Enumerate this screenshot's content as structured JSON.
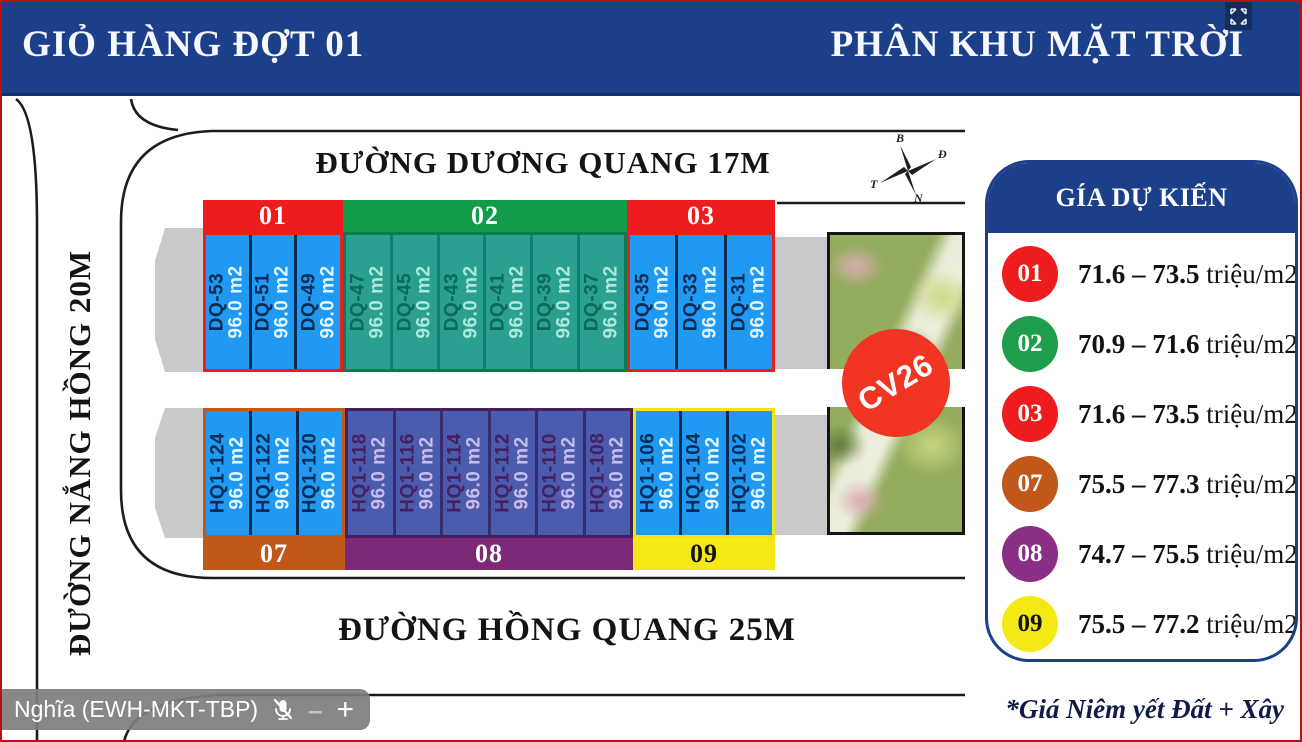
{
  "header": {
    "left_title": "GIỎ HÀNG ĐỢT 01",
    "right_title": "PHÂN KHU MẶT TRỜI",
    "bar_color": "#1c3f8a"
  },
  "streets": {
    "top": "ĐƯỜNG DƯƠNG QUANG 17M",
    "left": "ĐƯỜNG NẮNG HỒNG 20M",
    "bottom": "ĐƯỜNG HỒNG QUANG 25M"
  },
  "compass": {
    "north": "B",
    "east": "Đ",
    "west": "T",
    "south": "N"
  },
  "park": {
    "label": "CV26",
    "circle_color": "#f03522"
  },
  "map": {
    "blocks": [
      {
        "id": "01",
        "row": "top",
        "label": "01",
        "chrome": "#ee1c1c",
        "label_text": "#ffffff",
        "cell_bg": "#1f99f2",
        "name_color": "#0b2b55",
        "area_color": "#e2f7ff",
        "divider": "#0b2b55",
        "plots": [
          {
            "name": "DQ-53",
            "area": "96.0 m2"
          },
          {
            "name": "DQ-51",
            "area": "96.0 m2"
          },
          {
            "name": "DQ-49",
            "area": "96.0 m2"
          }
        ]
      },
      {
        "id": "02",
        "row": "top",
        "label": "02",
        "chrome": "#129b49",
        "label_text": "#ffffff",
        "cell_bg": "#2b9f90",
        "name_color": "#0a6a58",
        "area_color": "#aaeadb",
        "divider": "#0d8070",
        "border": "#0c7a4f",
        "plots": [
          {
            "name": "DQ-47",
            "area": "96.0 m2"
          },
          {
            "name": "DQ-45",
            "area": "96.0 m2"
          },
          {
            "name": "DQ-43",
            "area": "96.0 m2"
          },
          {
            "name": "DQ-41",
            "area": "96.0 m2"
          },
          {
            "name": "DQ-39",
            "area": "96.0 m2"
          },
          {
            "name": "DQ-37",
            "area": "96.0 m2"
          }
        ]
      },
      {
        "id": "03",
        "row": "top",
        "label": "03",
        "chrome": "#ee1c1c",
        "label_text": "#ffffff",
        "cell_bg": "#1f99f2",
        "name_color": "#0b2b55",
        "area_color": "#e2f7ff",
        "divider": "#0b2b55",
        "plots": [
          {
            "name": "DQ-35",
            "area": "96.0 m2"
          },
          {
            "name": "DQ-33",
            "area": "96.0 m2"
          },
          {
            "name": "DQ-31",
            "area": "96.0 m2"
          }
        ]
      },
      {
        "id": "07",
        "row": "bottom",
        "label": "07",
        "chrome": "#c2571b",
        "label_text": "#ffffff",
        "cell_bg": "#1f99f2",
        "name_color": "#0b2b55",
        "area_color": "#e2f7ff",
        "divider": "#0b2b55",
        "plots": [
          {
            "name": "HQ1-124",
            "area": "96.0 m2"
          },
          {
            "name": "HQ1-122",
            "area": "96.0 m2"
          },
          {
            "name": "HQ1-120",
            "area": "96.0 m2"
          }
        ]
      },
      {
        "id": "08",
        "row": "bottom",
        "label": "08",
        "chrome": "#7c2a78",
        "label_text": "#ffffff",
        "cell_bg": "#4b5cae",
        "name_color": "#46205e",
        "area_color": "#cbbcea",
        "divider": "#3c2a6e",
        "border": "#45205e",
        "plots": [
          {
            "name": "HQ1-118",
            "area": "96.0 m2"
          },
          {
            "name": "HQ1-116",
            "area": "96.0 m2"
          },
          {
            "name": "HQ1-114",
            "area": "96.0 m2"
          },
          {
            "name": "HQ1-112",
            "area": "96.0 m2"
          },
          {
            "name": "HQ1-110",
            "area": "96.0 m2"
          },
          {
            "name": "HQ1-108",
            "area": "96.0 m2"
          }
        ]
      },
      {
        "id": "09",
        "row": "bottom",
        "label": "09",
        "chrome": "#f5e915",
        "label_text": "#141414",
        "cell_bg": "#1f99f2",
        "name_color": "#0b2b55",
        "area_color": "#e2f7ff",
        "divider": "#0b2b55",
        "border": "#f0e415",
        "plots": [
          {
            "name": "HQ1-106",
            "area": "96.0 m2"
          },
          {
            "name": "HQ1-104",
            "area": "96.0 m2"
          },
          {
            "name": "HQ1-102",
            "area": "96.0 m2"
          }
        ]
      }
    ]
  },
  "legend": {
    "title": "GÍA DỰ KIẾN",
    "rows": [
      {
        "id": "01",
        "circle": "#ee1c1c",
        "num_color": "#ffffff",
        "range": "71.6 – 73.5",
        "unit": " triệu/m2"
      },
      {
        "id": "02",
        "circle": "#1e9e4a",
        "num_color": "#ffffff",
        "range": "70.9 – 71.6",
        "unit": " triệu/m2"
      },
      {
        "id": "03",
        "circle": "#ee1c1c",
        "num_color": "#ffffff",
        "range": "71.6 – 73.5",
        "unit": " triệu/m2"
      },
      {
        "id": "07",
        "circle": "#c2571b",
        "num_color": "#ffffff",
        "range": "75.5 – 77.3",
        "unit": " triệu/m2"
      },
      {
        "id": "08",
        "circle": "#8a2f85",
        "num_color": "#ffffff",
        "range": "74.7 – 75.5",
        "unit": " triệu/m2"
      },
      {
        "id": "09",
        "circle": "#f5e915",
        "num_color": "#141414",
        "range": "75.5 – 77.2",
        "unit": " triệu/m2"
      }
    ],
    "footnote": "*Giá Niêm yết Đất + Xây"
  },
  "nameplate": {
    "name": "Nghĩa (EWH-MKT-TBP)"
  }
}
